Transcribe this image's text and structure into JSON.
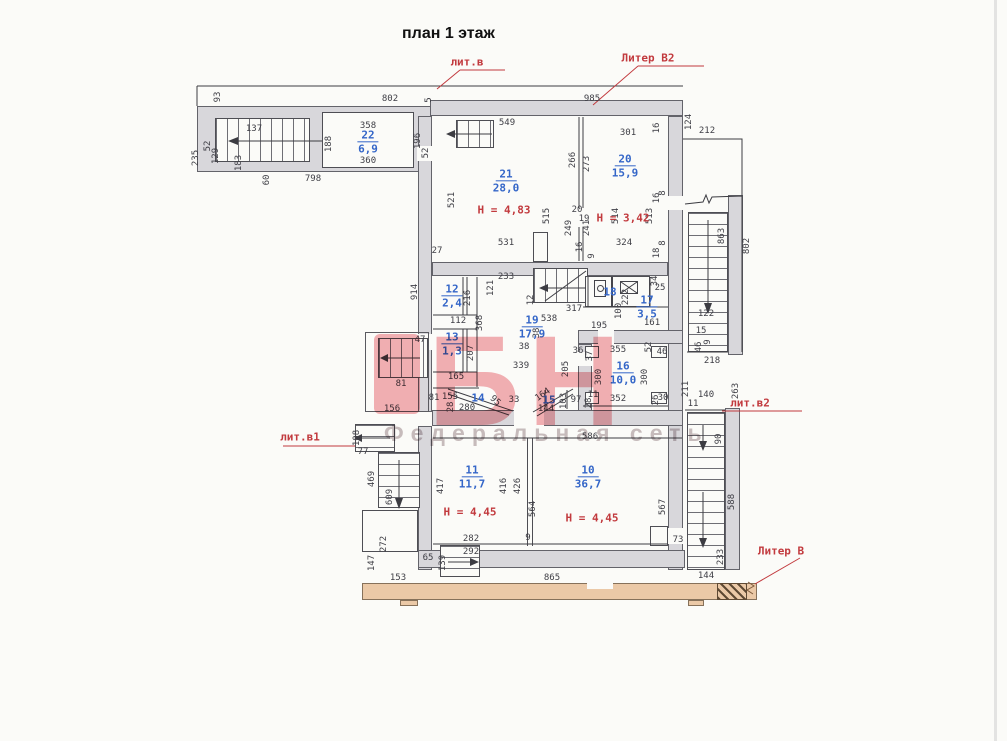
{
  "title": "план 1 этаж",
  "watermark": {
    "logo": "БН",
    "tagline": "Федеральная сеть"
  },
  "colors": {
    "wall": "#d8d7db",
    "dim_text": "#3e3e45",
    "room_number": "#3466c8",
    "annotation_red": "#c23a3e",
    "liter_building": "#ebc9a7",
    "watermark_pink": "#e9646e"
  },
  "liter_labels": [
    {
      "text": "лит.в",
      "x": 467,
      "y": 62
    },
    {
      "text": "Литер В2",
      "x": 648,
      "y": 58
    },
    {
      "text": "лит.в1",
      "x": 300,
      "y": 437
    },
    {
      "text": "лит.в2",
      "x": 750,
      "y": 403
    },
    {
      "text": "Литер В",
      "x": 781,
      "y": 551
    }
  ],
  "height_labels": [
    {
      "text": "Н = 4,83",
      "x": 504,
      "y": 210
    },
    {
      "text": "Н = 3,42",
      "x": 623,
      "y": 218
    },
    {
      "text": "Н = 4,45",
      "x": 470,
      "y": 512
    },
    {
      "text": "Н = 4,45",
      "x": 592,
      "y": 518
    }
  ],
  "rooms": [
    {
      "num": "22",
      "area": "6,9",
      "x": 368,
      "y": 142
    },
    {
      "num": "21",
      "area": "28,0",
      "x": 506,
      "y": 181
    },
    {
      "num": "20",
      "area": "15,9",
      "x": 625,
      "y": 166
    },
    {
      "num": "12",
      "area": "2,4",
      "x": 452,
      "y": 296
    },
    {
      "num": "13",
      "area": "1,3",
      "x": 452,
      "y": 344
    },
    {
      "num": "19",
      "area": "17,9",
      "x": 532,
      "y": 327
    },
    {
      "num": "18",
      "area": "",
      "x": 610,
      "y": 292
    },
    {
      "num": "17",
      "area": "3,5",
      "x": 647,
      "y": 307
    },
    {
      "num": "16",
      "area": "10,0",
      "x": 623,
      "y": 373
    },
    {
      "num": "14",
      "area": "",
      "x": 478,
      "y": 398
    },
    {
      "num": "15",
      "area": "",
      "x": 549,
      "y": 400
    },
    {
      "num": "11",
      "area": "11,7",
      "x": 472,
      "y": 477
    },
    {
      "num": "10",
      "area": "36,7",
      "x": 588,
      "y": 477
    }
  ],
  "dims": [
    {
      "t": "93",
      "x": 218,
      "y": 97,
      "r": -90
    },
    {
      "t": "802",
      "x": 390,
      "y": 99
    },
    {
      "t": "5",
      "x": 429,
      "y": 100,
      "r": -90
    },
    {
      "t": "985",
      "x": 592,
      "y": 99
    },
    {
      "t": "235",
      "x": 196,
      "y": 158,
      "r": -90
    },
    {
      "t": "52",
      "x": 208,
      "y": 146,
      "r": -90
    },
    {
      "t": "129",
      "x": 216,
      "y": 156,
      "r": -90
    },
    {
      "t": "137",
      "x": 254,
      "y": 129
    },
    {
      "t": "183",
      "x": 239,
      "y": 163,
      "r": -90
    },
    {
      "t": "60",
      "x": 267,
      "y": 180,
      "r": -90
    },
    {
      "t": "798",
      "x": 313,
      "y": 179
    },
    {
      "t": "358",
      "x": 368,
      "y": 126
    },
    {
      "t": "188",
      "x": 329,
      "y": 144,
      "r": -90
    },
    {
      "t": "360",
      "x": 368,
      "y": 161
    },
    {
      "t": "196",
      "x": 418,
      "y": 141,
      "r": -90
    },
    {
      "t": "52",
      "x": 426,
      "y": 153,
      "r": -90
    },
    {
      "t": "549",
      "x": 507,
      "y": 123
    },
    {
      "t": "521",
      "x": 452,
      "y": 200,
      "r": -90
    },
    {
      "t": "515",
      "x": 547,
      "y": 216,
      "r": -90
    },
    {
      "t": "531",
      "x": 506,
      "y": 243
    },
    {
      "t": "27",
      "x": 437,
      "y": 251
    },
    {
      "t": "266",
      "x": 573,
      "y": 160,
      "r": -90
    },
    {
      "t": "273",
      "x": 587,
      "y": 164,
      "r": -90
    },
    {
      "t": "20",
      "x": 577,
      "y": 210
    },
    {
      "t": "19",
      "x": 584,
      "y": 219
    },
    {
      "t": "249",
      "x": 569,
      "y": 228,
      "r": -90
    },
    {
      "t": "241",
      "x": 587,
      "y": 228,
      "r": -90
    },
    {
      "t": "16",
      "x": 580,
      "y": 247,
      "r": -90
    },
    {
      "t": "9",
      "x": 592,
      "y": 256,
      "r": -90
    },
    {
      "t": "301",
      "x": 628,
      "y": 133
    },
    {
      "t": "16",
      "x": 657,
      "y": 128,
      "r": -90
    },
    {
      "t": "514",
      "x": 616,
      "y": 216,
      "r": -90
    },
    {
      "t": "513",
      "x": 650,
      "y": 216,
      "r": -90
    },
    {
      "t": "16",
      "x": 657,
      "y": 198,
      "r": -90
    },
    {
      "t": "8",
      "x": 663,
      "y": 193,
      "r": -90
    },
    {
      "t": "324",
      "x": 624,
      "y": 243
    },
    {
      "t": "8",
      "x": 663,
      "y": 243,
      "r": -90
    },
    {
      "t": "18",
      "x": 657,
      "y": 253,
      "r": -90
    },
    {
      "t": "124",
      "x": 689,
      "y": 122,
      "r": -90
    },
    {
      "t": "212",
      "x": 707,
      "y": 131
    },
    {
      "t": "863",
      "x": 722,
      "y": 236,
      "r": -90
    },
    {
      "t": "802",
      "x": 747,
      "y": 246,
      "r": -90
    },
    {
      "t": "122",
      "x": 706,
      "y": 314
    },
    {
      "t": "15",
      "x": 701,
      "y": 331
    },
    {
      "t": "46",
      "x": 699,
      "y": 347,
      "r": -90
    },
    {
      "t": "9",
      "x": 708,
      "y": 342,
      "r": -90
    },
    {
      "t": "218",
      "x": 712,
      "y": 361
    },
    {
      "t": "914",
      "x": 415,
      "y": 292,
      "r": -90
    },
    {
      "t": "233",
      "x": 506,
      "y": 277
    },
    {
      "t": "121",
      "x": 491,
      "y": 288,
      "r": -90
    },
    {
      "t": "216",
      "x": 468,
      "y": 298,
      "r": -90
    },
    {
      "t": "112",
      "x": 458,
      "y": 321
    },
    {
      "t": "368",
      "x": 480,
      "y": 323,
      "r": -90
    },
    {
      "t": "207",
      "x": 471,
      "y": 353,
      "r": -90
    },
    {
      "t": "165",
      "x": 456,
      "y": 377
    },
    {
      "t": "12",
      "x": 531,
      "y": 300,
      "r": -90
    },
    {
      "t": "317",
      "x": 574,
      "y": 309
    },
    {
      "t": "538",
      "x": 549,
      "y": 319
    },
    {
      "t": "38",
      "x": 537,
      "y": 333,
      "r": -90
    },
    {
      "t": "38",
      "x": 524,
      "y": 347
    },
    {
      "t": "339",
      "x": 521,
      "y": 366
    },
    {
      "t": "47",
      "x": 420,
      "y": 340
    },
    {
      "t": "81",
      "x": 401,
      "y": 384
    },
    {
      "t": "156",
      "x": 392,
      "y": 409
    },
    {
      "t": "222",
      "x": 626,
      "y": 297,
      "r": -90
    },
    {
      "t": "34",
      "x": 655,
      "y": 281,
      "r": -90
    },
    {
      "t": "25",
      "x": 660,
      "y": 288
    },
    {
      "t": "100",
      "x": 619,
      "y": 311,
      "r": -90
    },
    {
      "t": "195",
      "x": 599,
      "y": 326
    },
    {
      "t": "161",
      "x": 652,
      "y": 323
    },
    {
      "t": "205",
      "x": 566,
      "y": 369,
      "r": -90
    },
    {
      "t": "36",
      "x": 578,
      "y": 351
    },
    {
      "t": "37",
      "x": 590,
      "y": 356,
      "r": -90
    },
    {
      "t": "355",
      "x": 618,
      "y": 350
    },
    {
      "t": "52",
      "x": 649,
      "y": 347,
      "r": -90
    },
    {
      "t": "46",
      "x": 662,
      "y": 352
    },
    {
      "t": "300",
      "x": 599,
      "y": 377,
      "r": -90
    },
    {
      "t": "300",
      "x": 645,
      "y": 377,
      "r": -90
    },
    {
      "t": "11",
      "x": 593,
      "y": 395
    },
    {
      "t": "97",
      "x": 576,
      "y": 400
    },
    {
      "t": "28",
      "x": 589,
      "y": 403,
      "r": -90
    },
    {
      "t": "352",
      "x": 618,
      "y": 399
    },
    {
      "t": "26",
      "x": 656,
      "y": 400,
      "r": -90
    },
    {
      "t": "30",
      "x": 663,
      "y": 398
    },
    {
      "t": "81",
      "x": 434,
      "y": 398
    },
    {
      "t": "155",
      "x": 450,
      "y": 397
    },
    {
      "t": "28",
      "x": 451,
      "y": 407,
      "r": -90
    },
    {
      "t": "280",
      "x": 467,
      "y": 408
    },
    {
      "t": "95",
      "x": 495,
      "y": 401,
      "r": 42
    },
    {
      "t": "33",
      "x": 514,
      "y": 400
    },
    {
      "t": "164",
      "x": 543,
      "y": 395,
      "r": -35
    },
    {
      "t": "103",
      "x": 564,
      "y": 401,
      "r": -90
    },
    {
      "t": "144",
      "x": 546,
      "y": 409
    },
    {
      "t": "586",
      "x": 590,
      "y": 437
    },
    {
      "t": "140",
      "x": 706,
      "y": 395
    },
    {
      "t": "11",
      "x": 693,
      "y": 404
    },
    {
      "t": "263",
      "x": 736,
      "y": 391,
      "r": -90
    },
    {
      "t": "211",
      "x": 686,
      "y": 389,
      "r": -90
    },
    {
      "t": "90",
      "x": 719,
      "y": 439,
      "r": -90
    },
    {
      "t": "588",
      "x": 732,
      "y": 502,
      "r": -90
    },
    {
      "t": "233",
      "x": 721,
      "y": 557,
      "r": -90
    },
    {
      "t": "144",
      "x": 706,
      "y": 576
    },
    {
      "t": "73",
      "x": 678,
      "y": 540
    },
    {
      "t": "567",
      "x": 663,
      "y": 507,
      "r": -90
    },
    {
      "t": "865",
      "x": 552,
      "y": 578
    },
    {
      "t": "153",
      "x": 398,
      "y": 578
    },
    {
      "t": "147",
      "x": 372,
      "y": 563,
      "r": -90
    },
    {
      "t": "272",
      "x": 384,
      "y": 544,
      "r": -90
    },
    {
      "t": "609",
      "x": 390,
      "y": 497,
      "r": -90
    },
    {
      "t": "469",
      "x": 372,
      "y": 479,
      "r": -90
    },
    {
      "t": "65",
      "x": 428,
      "y": 558
    },
    {
      "t": "139",
      "x": 443,
      "y": 563,
      "r": -90
    },
    {
      "t": "292",
      "x": 471,
      "y": 552
    },
    {
      "t": "282",
      "x": 471,
      "y": 539
    },
    {
      "t": "9",
      "x": 528,
      "y": 538
    },
    {
      "t": "417",
      "x": 441,
      "y": 486,
      "r": -90
    },
    {
      "t": "416",
      "x": 504,
      "y": 486,
      "r": -90
    },
    {
      "t": "426",
      "x": 518,
      "y": 486,
      "r": -90
    },
    {
      "t": "564",
      "x": 533,
      "y": 509,
      "r": -90
    },
    {
      "t": "108",
      "x": 357,
      "y": 438,
      "r": -90
    },
    {
      "t": "77",
      "x": 363,
      "y": 452
    }
  ]
}
